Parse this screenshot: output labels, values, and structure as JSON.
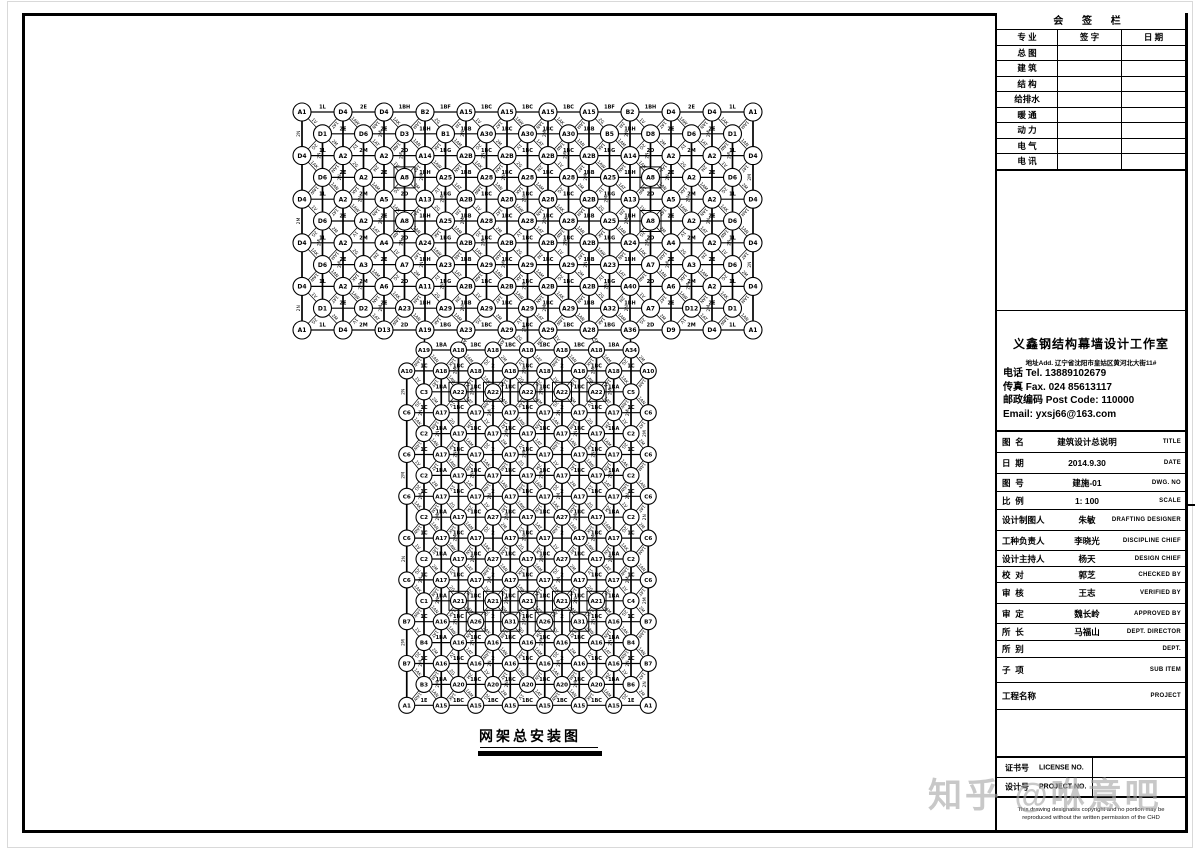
{
  "watermark": {
    "text": "知乎 @咻意吧"
  },
  "drawing": {
    "caption": "网架总安装图",
    "center_x": 527.5,
    "band": {
      "y0": 112,
      "rp": 21.8,
      "cp": 41,
      "node_r": 9,
      "rows": [
        [
          "A1",
          "D4",
          "D4",
          "B2",
          "A15",
          "A15",
          "A15",
          "A15",
          "B2",
          "D4",
          "D4",
          "A1"
        ],
        [
          "D1",
          "D6",
          "D3",
          "B1",
          "A30",
          "A30",
          "A30",
          "B5",
          "D8",
          "D6",
          "D1"
        ],
        [
          "D4",
          "A2",
          "A2",
          "A14",
          "A2B",
          "A2B",
          "A2B",
          "A2B",
          "A14",
          "A2",
          "A2",
          "D4"
        ],
        [
          "D6",
          "A2",
          "A8",
          "A25",
          "A28",
          "A28",
          "A28",
          "A25",
          "A8",
          "A2",
          "D6"
        ],
        [
          "D4",
          "A2",
          "A5",
          "A13",
          "A2B",
          "A28",
          "A28",
          "A2B",
          "A13",
          "A5",
          "A2",
          "D4"
        ],
        [
          "D6",
          "A2",
          "A8",
          "A25",
          "A28",
          "A28",
          "A28",
          "A25",
          "A8",
          "A2",
          "D6"
        ],
        [
          "D4",
          "A2",
          "A4",
          "A24",
          "A2B",
          "A2B",
          "A2B",
          "A2B",
          "A24",
          "A4",
          "A2",
          "D4"
        ],
        [
          "D6",
          "A3",
          "A7",
          "A23",
          "A29",
          "A29",
          "A29",
          "A23",
          "A7",
          "A3",
          "D6"
        ],
        [
          "D4",
          "A2",
          "A6",
          "A11",
          "A2B",
          "A2B",
          "A2B",
          "A2B",
          "A40",
          "A6",
          "A2",
          "D4"
        ],
        [
          "D1",
          "D2",
          "A23",
          "A29",
          "A29",
          "A29",
          "A29",
          "A32",
          "A7",
          "D12",
          "D1"
        ],
        [
          "A1",
          "D4",
          "D13",
          "A19",
          "A23",
          "A29",
          "A29",
          "A28",
          "A36",
          "D9",
          "D4",
          "A1"
        ]
      ]
    },
    "stem": {
      "y0": 350,
      "rp": 20.9,
      "cp": 34.5,
      "node_r": 8,
      "rows": [
        [
          "A19",
          "A18",
          "A18",
          "A18",
          "A18",
          "A18",
          "A34"
        ],
        [
          "A10",
          "A18",
          "A18",
          "A18",
          "A18",
          "A18",
          "A18",
          "A10"
        ],
        [
          "C3",
          "A22",
          "A22",
          "A22",
          "A22",
          "A22",
          "C5"
        ],
        [
          "C6",
          "A17",
          "A17",
          "A17",
          "A17",
          "A17",
          "A17",
          "C6"
        ],
        [
          "C2",
          "A17",
          "A17",
          "A17",
          "A17",
          "A17",
          "C2"
        ],
        [
          "C6",
          "A17",
          "A17",
          "A17",
          "A17",
          "A17",
          "A17",
          "C6"
        ],
        [
          "C2",
          "A17",
          "A17",
          "A17",
          "A17",
          "A17",
          "C2"
        ],
        [
          "C6",
          "A17",
          "A17",
          "A17",
          "A17",
          "A17",
          "A17",
          "C6"
        ],
        [
          "C2",
          "A17",
          "A27",
          "A17",
          "A27",
          "A17",
          "C2"
        ],
        [
          "C6",
          "A17",
          "A17",
          "A17",
          "A17",
          "A17",
          "A17",
          "C6"
        ],
        [
          "C2",
          "A17",
          "A27",
          "A17",
          "A27",
          "A17",
          "C2"
        ],
        [
          "C6",
          "A17",
          "A17",
          "A17",
          "A17",
          "A17",
          "A17",
          "C6"
        ],
        [
          "C1",
          "A21",
          "A21",
          "A21",
          "A21",
          "A21",
          "C4"
        ],
        [
          "B7",
          "A16",
          "A26",
          "A31",
          "A26",
          "A31",
          "A16",
          "B7"
        ],
        [
          "B4",
          "A16",
          "A16",
          "A16",
          "A16",
          "A16",
          "B4"
        ],
        [
          "B7",
          "A16",
          "A16",
          "A16",
          "A16",
          "A16",
          "A16",
          "B7"
        ],
        [
          "B3",
          "A20",
          "A20",
          "A20",
          "A20",
          "A20",
          "B6"
        ],
        [
          "A1",
          "A15",
          "A15",
          "A15",
          "A15",
          "A15",
          "A15",
          "A1"
        ]
      ]
    },
    "member_labels": {
      "band_top": [
        "1L",
        "2E",
        "1BH",
        "1BF",
        "1BC",
        "1BC",
        "1BC",
        "1BF",
        "1BH",
        "2E",
        "1L"
      ],
      "band_odd": [
        "2E",
        "2E",
        "1BH",
        "1BB",
        "1BC",
        "1BC",
        "1BB",
        "1BH",
        "2E",
        "2E"
      ],
      "band_even": [
        "1L",
        "2M",
        "2D",
        "1BG",
        "1BC",
        "1BC",
        "1BC",
        "1BG",
        "2D",
        "2M",
        "1L"
      ],
      "stem7": [
        "1BA",
        "1BC",
        "1BC",
        "1BC",
        "1BC",
        "1BA"
      ],
      "stem8": [
        "1C",
        "1BC",
        "2",
        "1BC",
        "2",
        "1BC",
        "1C"
      ],
      "stem_bottom": [
        "1E",
        "1BC",
        "1BC",
        "1BC",
        "1BC",
        "1BC",
        "1E"
      ],
      "diag_cycle": [
        "1V",
        "1AT",
        "1AW",
        "1AN",
        "1AK",
        "1AM",
        "2G",
        "2M"
      ],
      "vert_cycle": [
        "2N",
        "2M"
      ]
    },
    "square_nodes": [
      "A8",
      "A21",
      "A22",
      "A26",
      "A31"
    ]
  },
  "titleblock": {
    "signoff": {
      "header": "会 签 栏",
      "cols": [
        "专 业",
        "签 字",
        "日 期"
      ],
      "rows": [
        "总 图",
        "建 筑",
        "结 构",
        "给排水",
        "暖 通",
        "动 力",
        "电 气",
        "电 讯"
      ]
    },
    "company": {
      "name": "义鑫钢结构幕墙设计工作室",
      "address": "地址Add. 辽宁省沈阳市皇姑区黄河北大街11#",
      "tel": "电话 Tel.  13889102679",
      "fax": "传真 Fax. 024 85613117",
      "post": "邮政编码 Post Code: 110000",
      "email": "Email: yxsj66@163.com"
    },
    "rows": [
      {
        "label": "图  名",
        "value": "建筑设计总说明",
        "en": "TITLE"
      },
      {
        "label": "日  期",
        "value": "2014.9.30",
        "en": "DATE"
      },
      {
        "label": "图  号",
        "value": "建施-01",
        "en": "DWG. NO"
      },
      {
        "label": "比  例",
        "value": "1: 100",
        "en": "SCALE"
      },
      {
        "label": "设计制图人",
        "value": "朱敏",
        "en": "DRAFTING DESIGNER"
      },
      {
        "label": "工种负责人",
        "value": "李晓光",
        "en": "DISCIPLINE CHIEF"
      },
      {
        "label": "设计主持人",
        "value": "杨天",
        "en": "DESIGN CHIEF"
      },
      {
        "label": "校  对",
        "value": "郭芝",
        "en": "CHECKED BY"
      },
      {
        "label": "审  核",
        "value": "王志",
        "en": "VERIFIED BY"
      },
      {
        "label": "审  定",
        "value": "魏长岭",
        "en": "APPROVED BY"
      },
      {
        "label": "所  长",
        "value": "马福山",
        "en": "DEPT. DIRECTOR"
      },
      {
        "label": "所  别",
        "value": "",
        "en": "DEPT."
      },
      {
        "label": "子  项",
        "value": "",
        "en": "SUB ITEM"
      },
      {
        "label": "工程名称",
        "value": "",
        "en": "PROJECT"
      }
    ],
    "bottom": {
      "license_label": "证书号",
      "license_en": "LICENSE NO.",
      "project_label": "设计号",
      "project_en": "PROJECT NO.",
      "disclaimer": [
        "This drawing designates copyright and no portion may be",
        "reproduced without the written permission of the CHD"
      ]
    }
  }
}
